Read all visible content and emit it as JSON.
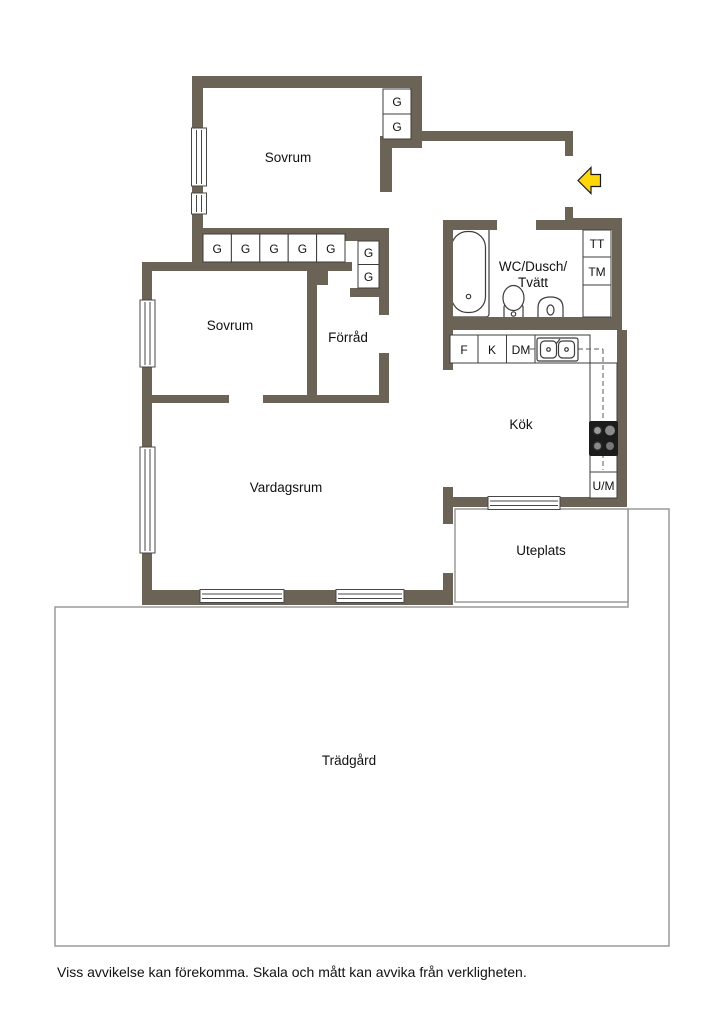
{
  "colors": {
    "wall": "#6b6355",
    "boundary": "#9a9a9a",
    "text": "#111111",
    "arrow_fill": "#ffd60a",
    "arrow_stroke": "#1a1a1a"
  },
  "rooms": {
    "sovrum1": "Sovrum",
    "sovrum2": "Sovrum",
    "forrad": "Förråd",
    "vardagsrum": "Vardagsrum",
    "wc_line1": "WC/Dusch/",
    "wc_line2": "Tvätt",
    "kok": "Kök",
    "uteplats": "Uteplats",
    "tradgard": "Trädgård"
  },
  "fixtures": {
    "wardrobe": "G",
    "dryer": "TT",
    "washer": "TM",
    "freezer": "F",
    "fridge": "K",
    "dishwasher": "DM",
    "oven_micro": "U/M"
  },
  "footer": {
    "disclaimer": "Viss avvikelse kan förekomma. Skala och mått kan avvika från verkligheten."
  }
}
